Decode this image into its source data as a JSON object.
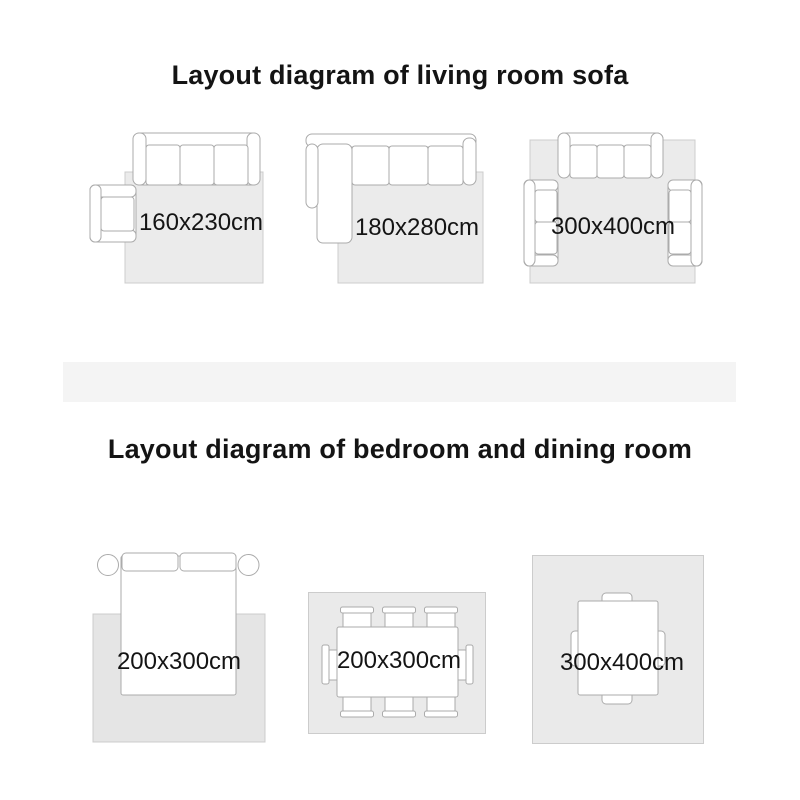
{
  "colors": {
    "band": "#f4f4f4",
    "line": "#ababab",
    "rug-top": "#ebebeb",
    "rug-bed": "#e5e5e5",
    "rug-dining": "#eaeaea",
    "rug-border": "#cccccc",
    "text": "#141414"
  },
  "sections": [
    {
      "title": "Layout diagram of living room sofa",
      "diagrams": [
        {
          "name": "sofa-with-armchair",
          "label": "160x230cm"
        },
        {
          "name": "l-shaped-sectional",
          "label": "180x280cm"
        },
        {
          "name": "sofa-with-two-loveseats",
          "label": "300x400cm"
        }
      ]
    },
    {
      "title": "Layout diagram of bedroom and dining room",
      "diagrams": [
        {
          "name": "bed-with-nightstands",
          "label": "200x300cm"
        },
        {
          "name": "dining-table-six-chairs",
          "label": "200x300cm"
        },
        {
          "name": "table-four-chairs",
          "label": "300x400cm"
        }
      ]
    }
  ]
}
